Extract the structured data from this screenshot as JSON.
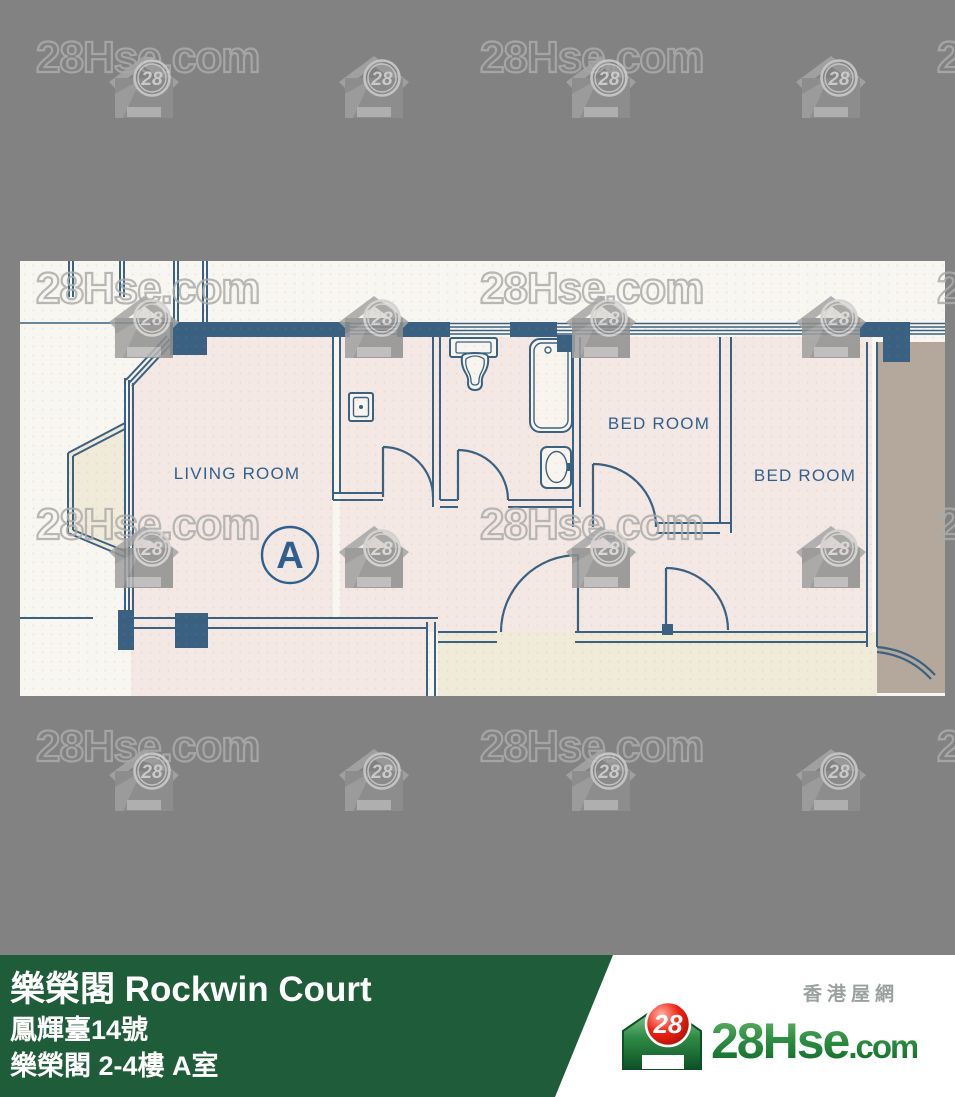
{
  "watermark": {
    "text": "28Hse.com",
    "badge": "28"
  },
  "floorplan": {
    "living_room": "LIVING ROOM",
    "bedroom1": "BED ROOM",
    "bedroom2": "BED ROOM",
    "unit_label": "A"
  },
  "footer": {
    "title": "樂榮閣 Rockwin Court",
    "address": "鳳輝臺14號",
    "unit": "樂榮閣 2-4樓 A室",
    "site_zh": "香港屋網",
    "logo_badge": "28",
    "logo_brand": "28Hse",
    "logo_tld": ".com"
  },
  "colors": {
    "background_gray": "#828282",
    "footer_green": "#1f5c39",
    "plan_wall_blue": "#3a6181",
    "plan_label_blue": "#2f5f8e",
    "room_pink": "#f3e8e3",
    "bay_beige": "#f0ead9",
    "neighbor_brown": "#b3a89b",
    "logo_red": "#e02416",
    "logo_green": "#2f9045"
  }
}
